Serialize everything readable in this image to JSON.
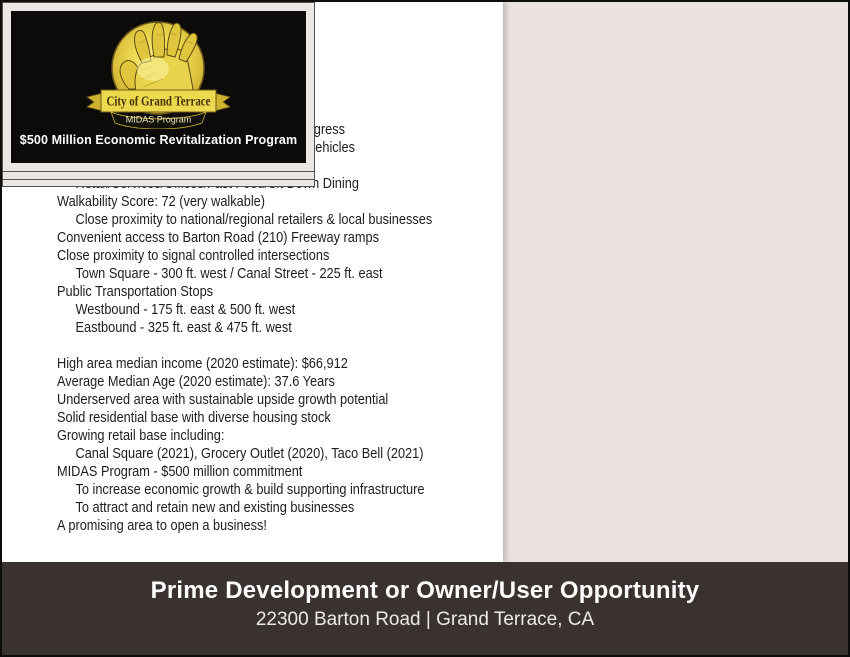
{
  "profile_tab": "Profile",
  "lines": [
    {
      "text": "Prime development opportunity",
      "indent": false
    },
    {
      "text": "Major arterial location...right in the path of progress",
      "indent": false
    },
    {
      "text": "Daily bi-directional traffic volume: 28,000 +/- vehicles",
      "indent": false
    },
    {
      "text": "General Commercial zoning - includes:",
      "indent": false
    },
    {
      "text": "Retail/Services/Offices/Fast Food/Sit Down Dining",
      "indent": true
    },
    {
      "text": "Walkability Score: 72 (very walkable)",
      "indent": false
    },
    {
      "text": "Close proximity to national/regional retailers & local businesses",
      "indent": true
    },
    {
      "text": "Convenient access to Barton Road (210) Freeway ramps",
      "indent": false
    },
    {
      "text": "Close proximity to signal controlled intersections",
      "indent": false
    },
    {
      "text": "Town Square - 300 ft. west / Canal Street - 225 ft. east",
      "indent": true
    },
    {
      "text": "Public Transportation Stops",
      "indent": false
    },
    {
      "text": "Westbound - 175 ft. east & 500 ft. west",
      "indent": true
    },
    {
      "text": "Eastbound - 325 ft. east & 475 ft. west",
      "indent": true
    },
    {
      "text": "",
      "indent": false
    },
    {
      "text": "High area median income (2020 estimate): $66,912",
      "indent": false
    },
    {
      "text": "Average Median Age (2020 estimate): 37.6 Years",
      "indent": false
    },
    {
      "text": "Underserved area with sustainable upside growth potential",
      "indent": false
    },
    {
      "text": "Solid residential base with diverse housing stock",
      "indent": false
    },
    {
      "text": "Growing retail base including:",
      "indent": false
    },
    {
      "text": "Canal Square (2021), Grocery Outlet (2020), Taco Bell (2021)",
      "indent": true
    },
    {
      "text": "MIDAS Program - $500 million commitment",
      "indent": false
    },
    {
      "text": "To increase economic growth & build supporting infrastructure",
      "indent": true
    },
    {
      "text": "To attract and retain new and existing businesses",
      "indent": true
    },
    {
      "text": "A promising area to open a business!",
      "indent": false
    }
  ],
  "badge": {
    "banner": "City of Grand Terrace",
    "sub_banner": "MIDAS Program",
    "caption": "$500 Million Economic Revitalization Program"
  },
  "footer": {
    "title": "Prime Development or Owner/User Opportunity",
    "subtitle": "22300 Barton Road | Grand Terrace, CA"
  },
  "colors": {
    "tab_bg": "#998f88",
    "panel_bg": "#e9e2e0",
    "footer_bg": "#3a322f",
    "badge_bg": "#0c0b09",
    "badge_gold": "#ecd94e"
  }
}
